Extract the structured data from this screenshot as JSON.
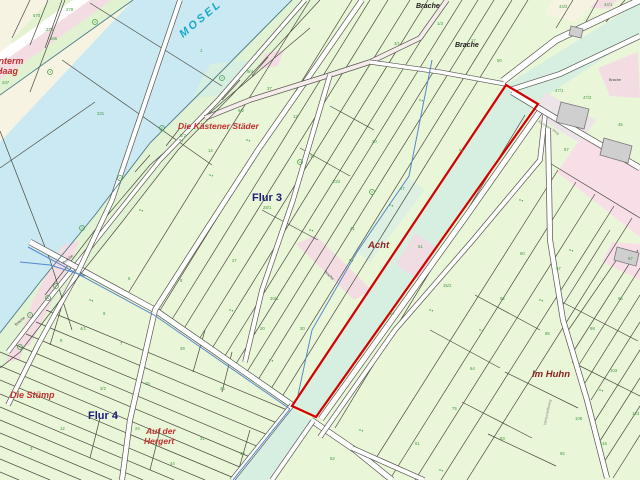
{
  "map": {
    "water_label": "MOSEL",
    "field_names": {
      "unterm_haag_line1": "Unterm",
      "unterm_haag_line2": "Haag",
      "kaestener_staeder": "Die Kästener Städer",
      "acht": "Acht",
      "im_huhn": "Im Huhn",
      "die_stuemp": "Die Stümp",
      "auf_der_line1": "Auf der",
      "auf_der_line2": "Hergert"
    },
    "flur_labels": {
      "flur3": "Flur 3",
      "flur3_num": "28/1",
      "flur4": "Flur 4"
    },
    "brache_labels": {
      "top1": "Brache",
      "top2": "Brache",
      "ne": "Brache",
      "bank1": "Brache",
      "bank2": "Brache",
      "center": "Brache"
    },
    "street_labels": {
      "ne": "Kestener Weg",
      "east": "Wirtschaftsweg"
    },
    "parcel_numbers": [
      {
        "t": "278",
        "x": 66,
        "y": 11
      },
      {
        "t": "570",
        "x": 33,
        "y": 17
      },
      {
        "t": "273",
        "x": 46,
        "y": 31
      },
      {
        "t": "286",
        "x": 50,
        "y": 40
      },
      {
        "t": "237",
        "x": 2,
        "y": 84
      },
      {
        "t": "231",
        "x": 97,
        "y": 115
      },
      {
        "t": "1",
        "x": 200,
        "y": 52
      },
      {
        "t": "9/4",
        "x": 247,
        "y": 73
      },
      {
        "t": "9/2",
        "x": 238,
        "y": 112
      },
      {
        "t": "14",
        "x": 208,
        "y": 152
      },
      {
        "t": "5/2",
        "x": 180,
        "y": 137
      },
      {
        "t": "37",
        "x": 267,
        "y": 90
      },
      {
        "t": "12",
        "x": 293,
        "y": 118
      },
      {
        "t": "17",
        "x": 310,
        "y": 158
      },
      {
        "t": "27",
        "x": 232,
        "y": 262
      },
      {
        "t": "8",
        "x": 180,
        "y": 282
      },
      {
        "t": "6",
        "x": 128,
        "y": 280
      },
      {
        "t": "41",
        "x": 350,
        "y": 230
      },
      {
        "t": "10/2",
        "x": 332,
        "y": 183
      },
      {
        "t": "20",
        "x": 372,
        "y": 143
      },
      {
        "t": "47",
        "x": 400,
        "y": 190
      },
      {
        "t": "61",
        "x": 418,
        "y": 248
      },
      {
        "t": "15/2",
        "x": 443,
        "y": 287
      },
      {
        "t": "57",
        "x": 390,
        "y": 315
      },
      {
        "t": "30",
        "x": 300,
        "y": 330
      },
      {
        "t": "20",
        "x": 260,
        "y": 330
      },
      {
        "t": "1/3",
        "x": 437,
        "y": 25
      },
      {
        "t": "17",
        "x": 471,
        "y": 42
      },
      {
        "t": "50",
        "x": 497,
        "y": 62
      },
      {
        "t": "3/1",
        "x": 394,
        "y": 45
      },
      {
        "t": "44/2",
        "x": 559,
        "y": 8
      },
      {
        "t": "44/1",
        "x": 604,
        "y": 6
      },
      {
        "t": "47/1",
        "x": 555,
        "y": 92
      },
      {
        "t": "47/2",
        "x": 583,
        "y": 99
      },
      {
        "t": "45",
        "x": 618,
        "y": 126
      },
      {
        "t": "57",
        "x": 564,
        "y": 151
      },
      {
        "t": "60",
        "x": 520,
        "y": 255
      },
      {
        "t": "67",
        "x": 556,
        "y": 270
      },
      {
        "t": "62",
        "x": 500,
        "y": 300
      },
      {
        "t": "85",
        "x": 545,
        "y": 335
      },
      {
        "t": "98",
        "x": 590,
        "y": 330
      },
      {
        "t": "103",
        "x": 610,
        "y": 372
      },
      {
        "t": "108",
        "x": 575,
        "y": 420
      },
      {
        "t": "116",
        "x": 600,
        "y": 445
      },
      {
        "t": "57",
        "x": 628,
        "y": 260
      },
      {
        "t": "64",
        "x": 470,
        "y": 370
      },
      {
        "t": "75",
        "x": 452,
        "y": 410
      },
      {
        "t": "83",
        "x": 500,
        "y": 440
      },
      {
        "t": "92",
        "x": 560,
        "y": 455
      },
      {
        "t": "123",
        "x": 632,
        "y": 415
      },
      {
        "t": "95",
        "x": 618,
        "y": 300
      },
      {
        "t": "7",
        "x": 120,
        "y": 345
      },
      {
        "t": "29",
        "x": 180,
        "y": 350
      },
      {
        "t": "4/1",
        "x": 80,
        "y": 330
      },
      {
        "t": "9",
        "x": 103,
        "y": 315
      },
      {
        "t": "8",
        "x": 60,
        "y": 342
      },
      {
        "t": "15",
        "x": 145,
        "y": 385
      },
      {
        "t": "25",
        "x": 220,
        "y": 390
      },
      {
        "t": "2/2",
        "x": 100,
        "y": 390
      },
      {
        "t": "24",
        "x": 135,
        "y": 430
      },
      {
        "t": "31",
        "x": 200,
        "y": 440
      },
      {
        "t": "12",
        "x": 60,
        "y": 430
      },
      {
        "t": "3",
        "x": 30,
        "y": 450
      },
      {
        "t": "44",
        "x": 170,
        "y": 465
      },
      {
        "t": "40",
        "x": 240,
        "y": 455
      },
      {
        "t": "20/1",
        "x": 270,
        "y": 300
      },
      {
        "t": "52",
        "x": 330,
        "y": 460
      },
      {
        "t": "61",
        "x": 415,
        "y": 445
      }
    ],
    "colors": {
      "river": "#cbe9f2",
      "riveredge": "#4a7a88",
      "parcel": "#eaf6d8",
      "bank": "#e2f3d4",
      "teal": "#d7efe1",
      "pink": "#f3dde3",
      "pinkroad": "#f6ecec",
      "cream": "#f6f3e3",
      "building": "#cfcfcf",
      "boundary": "#4a4a40",
      "roadedge": "#55564e",
      "selection": "#d40000",
      "stream": "#5588cc",
      "mosel": "#16a8cc",
      "navy": "#1b1b78",
      "fieldred": "#c23030",
      "maroon": "#8c2020",
      "num": "#3f9b3f"
    }
  }
}
